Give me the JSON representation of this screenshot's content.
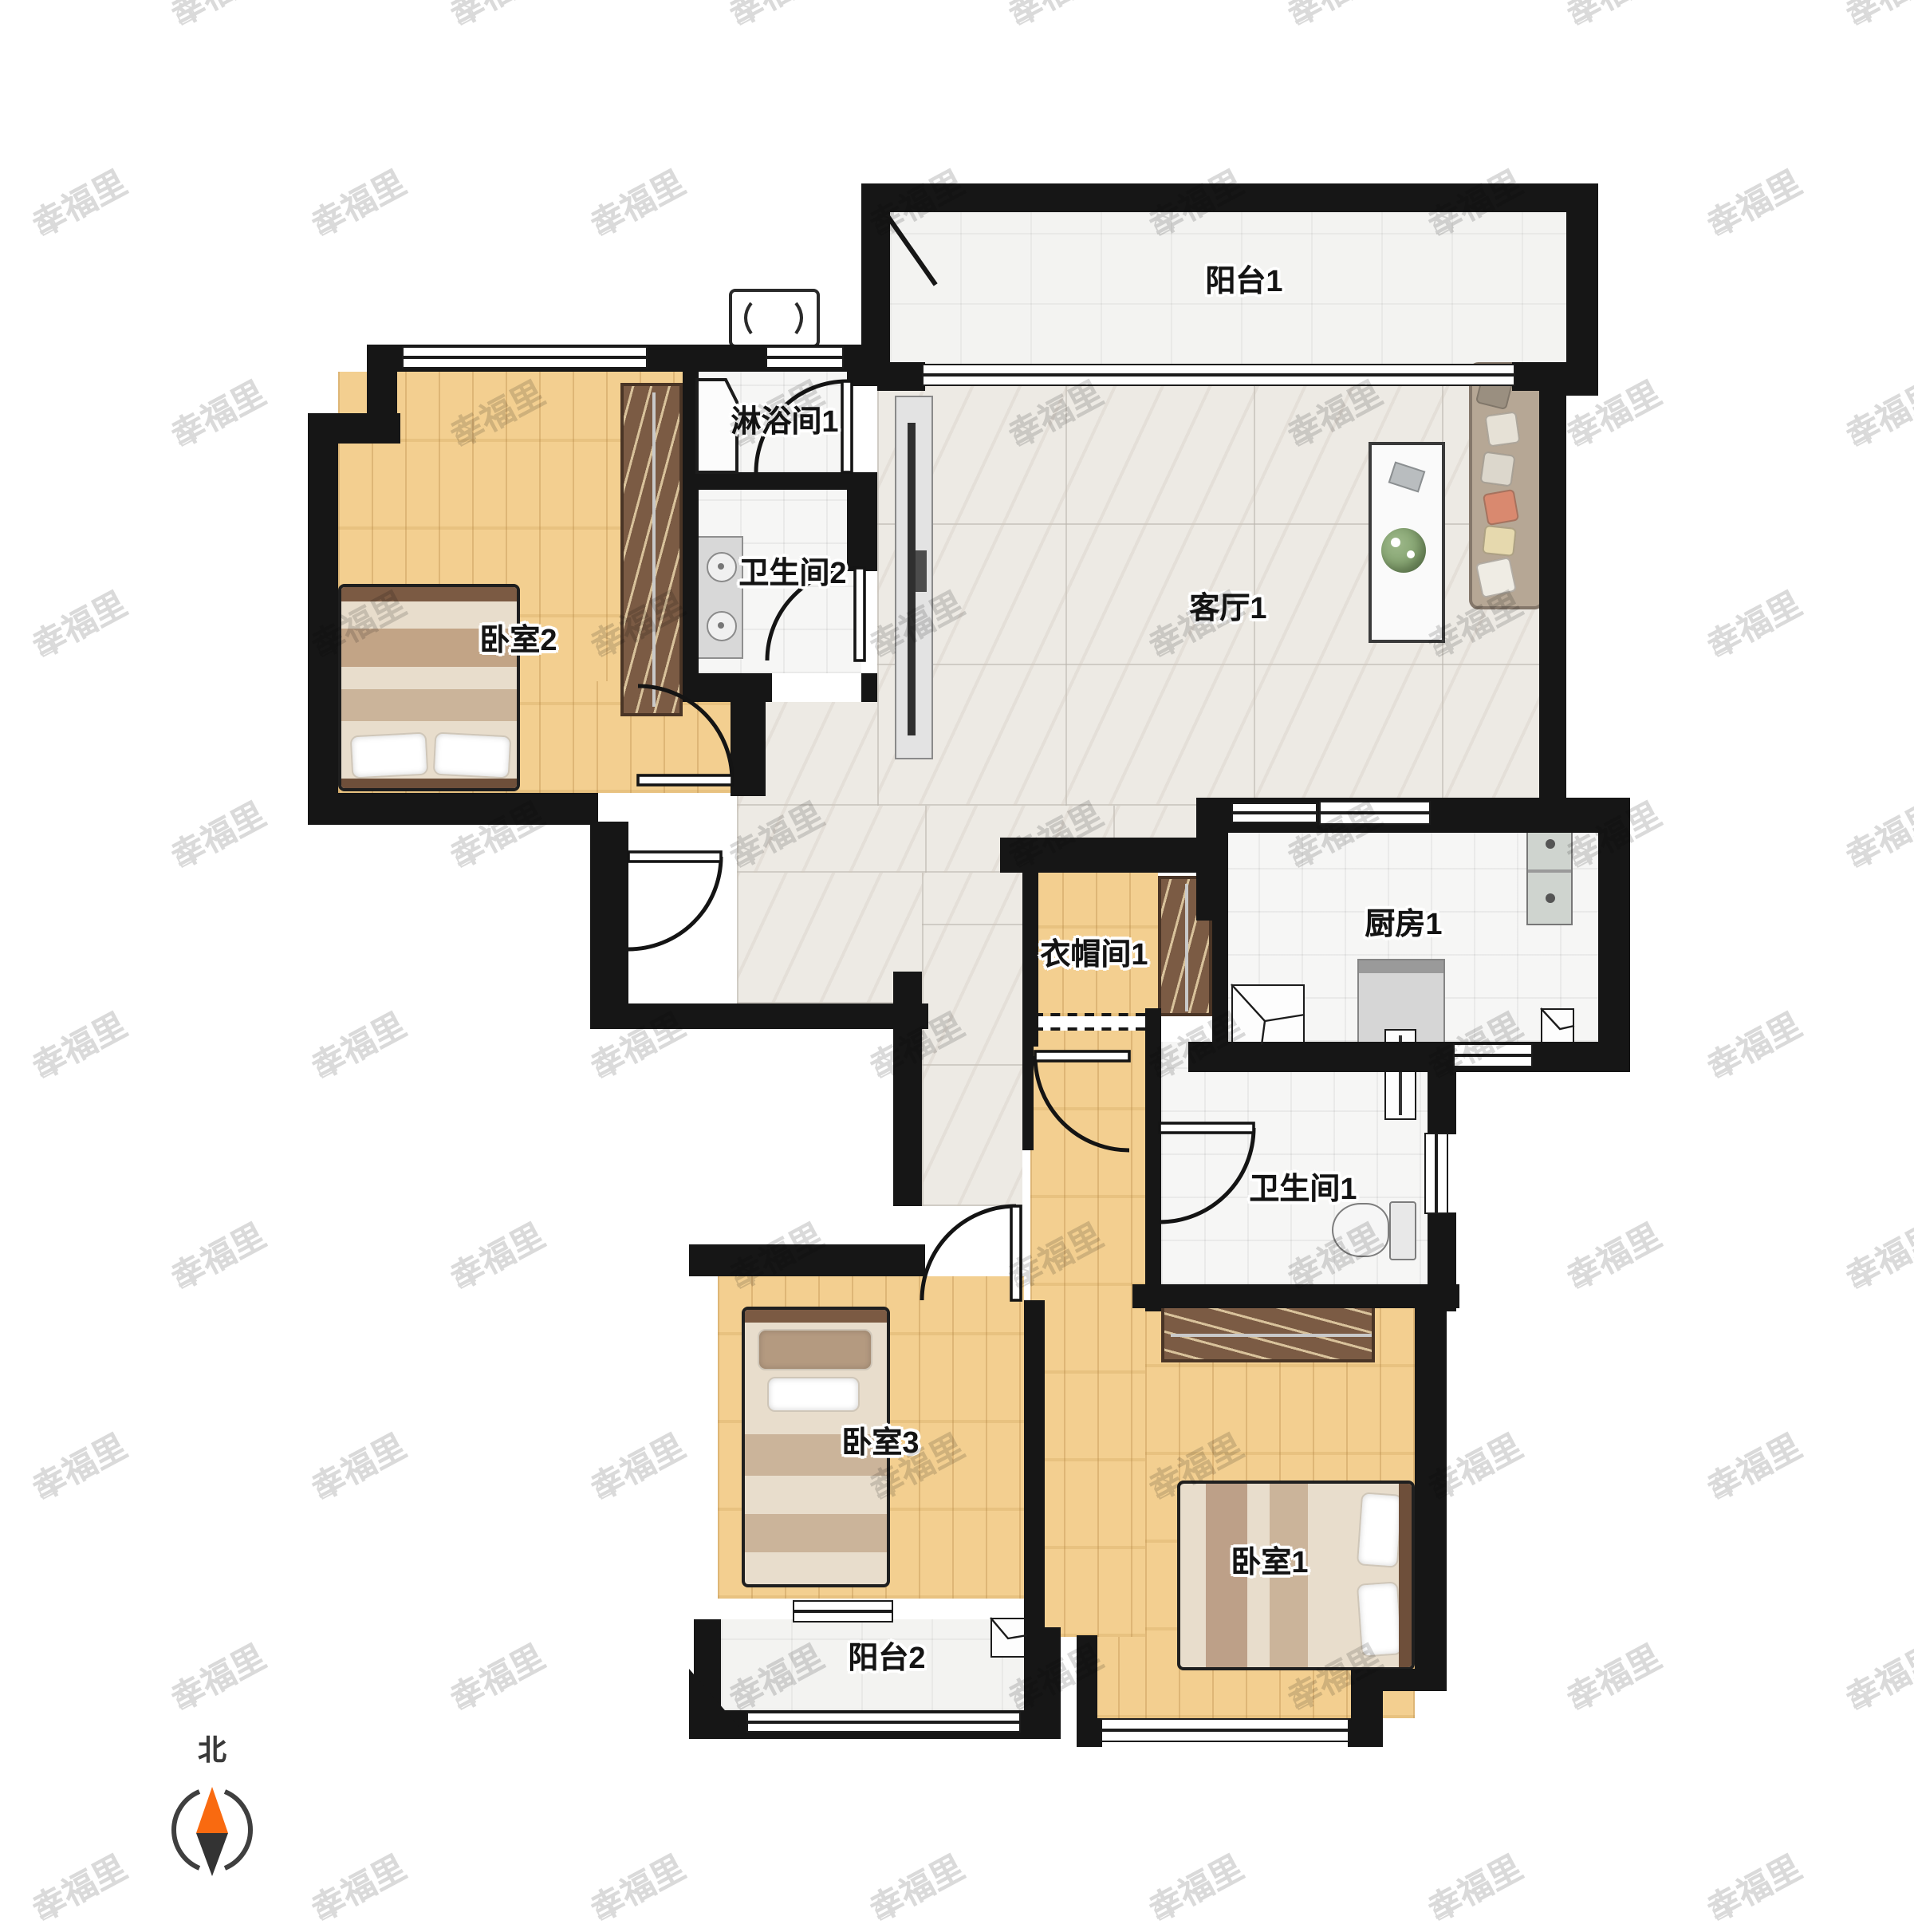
{
  "meta": {
    "type": "floor-plan",
    "orientation_mark": "north"
  },
  "palette": {
    "wall": "#161616",
    "wood": "#f3cf90",
    "marble": "#edeae4",
    "tile": "#f6f6f5",
    "wardrobe": "#7b5b44",
    "compass_north": "#f96a10",
    "compass_south": "#3a3a3a",
    "watermark": "#bcbcbc"
  },
  "watermark": {
    "text": "幸福里",
    "icon": "house-icon"
  },
  "compass": {
    "label": "北"
  },
  "rooms": [
    {
      "id": "balcony-1",
      "label": "阳台1"
    },
    {
      "id": "shower-1",
      "label": "淋浴间1"
    },
    {
      "id": "bathroom-2",
      "label": "卫生间2"
    },
    {
      "id": "bedroom-2",
      "label": "卧室2"
    },
    {
      "id": "living-1",
      "label": "客厅1"
    },
    {
      "id": "kitchen-1",
      "label": "厨房1"
    },
    {
      "id": "cloakroom-1",
      "label": "衣帽间1"
    },
    {
      "id": "bathroom-1",
      "label": "卫生间1"
    },
    {
      "id": "bedroom-3",
      "label": "卧室3"
    },
    {
      "id": "bedroom-1",
      "label": "卧室1"
    },
    {
      "id": "balcony-2",
      "label": "阳台2"
    }
  ]
}
